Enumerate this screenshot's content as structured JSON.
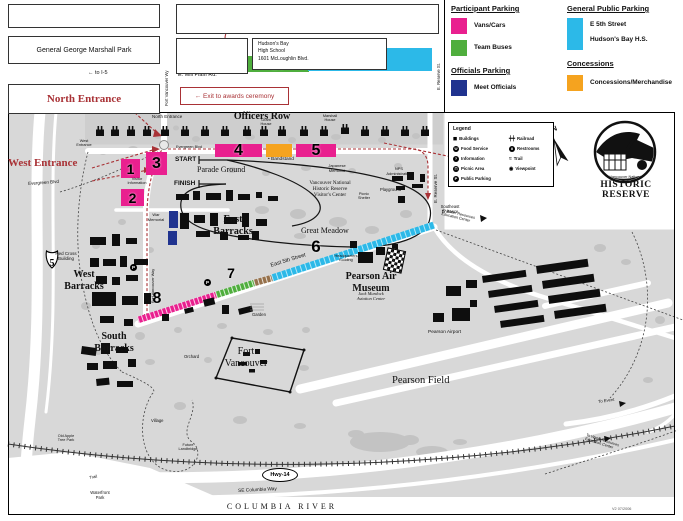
{
  "colors": {
    "pink": "#e9208f",
    "green": "#4fae3d",
    "cyan": "#2cb9e8",
    "navy": "#20338f",
    "orange": "#f5a31f",
    "red": "#a93236"
  },
  "top": {
    "marshall_park": "General George Marshall Park",
    "north_entrance": "North Entrance",
    "exit_note": "← Exit to awards ceremony",
    "school_lines": "Hudson's Bay\nHigh School\n1601 McLoughlin Blvd."
  },
  "legend": {
    "participant_title": "Participant Parking",
    "vans_cars": "Vans/Cars",
    "team_buses": "Team Buses",
    "officials_title": "Officials Parking",
    "meet_officials": "Meet Officials",
    "public_title": "General Public Parking",
    "public_line1": "E 5th Street",
    "public_line2": "Hudson's Bay H.S.",
    "concessions_title": "Concessions",
    "concessions_label": "Concessions/Merchandise"
  },
  "map_legend": {
    "title": "Legend",
    "col1": [
      {
        "g": "◼",
        "label": "Buildings",
        "plain": true
      },
      {
        "g": "Ψ",
        "label": "Food Service"
      },
      {
        "g": "?",
        "label": "Information"
      },
      {
        "g": "⊓",
        "label": "Picnic Area"
      },
      {
        "g": "P",
        "label": "Public Parking"
      }
    ],
    "col2": [
      {
        "g": "┿┿",
        "label": "Railroad",
        "plain": true
      },
      {
        "g": "ii",
        "label": "Restrooms"
      },
      {
        "g": "≈",
        "label": "Trail",
        "plain": true
      },
      {
        "g": "◉",
        "label": "Viewpoint",
        "plain": true
      }
    ]
  },
  "map": {
    "i5_label": "5",
    "labels": [
      {
        "id": "officers-row-label",
        "t": "Officers Row",
        "x": 262,
        "y": 111,
        "fs": 10,
        "serif": true,
        "b": true,
        "ctr": true
      },
      {
        "id": "north-entrance-map-label",
        "t": "North Entrance",
        "x": 152,
        "y": 114,
        "fs": 4.5
      },
      {
        "id": "grant-house-label",
        "t": "Grant\nHouse",
        "x": 266,
        "y": 118,
        "fs": 3.8,
        "ctr": true
      },
      {
        "id": "marshall-house-label",
        "t": "Marshall\nHouse",
        "x": 330,
        "y": 114,
        "fs": 3.8,
        "ctr": true
      },
      {
        "id": "evergreen-blvd-top-label",
        "t": "Evergreen Blvd",
        "x": 176,
        "y": 145,
        "fs": 3.8
      },
      {
        "id": "west-entrance-map-label",
        "t": "West\nEntrance",
        "x": 84,
        "y": 139,
        "fs": 3.8,
        "ctr": true
      },
      {
        "id": "west-entrance-label",
        "t": "West Entrance",
        "x": 8,
        "y": 157,
        "fs": 11,
        "serif": true,
        "b": true,
        "red": true
      },
      {
        "id": "evergreen-blvd-west-label",
        "t": "Evergreen Blvd",
        "x": 28,
        "y": 181,
        "fs": 4.5,
        "rot": -4
      },
      {
        "id": "start-label",
        "t": "START",
        "x": 175,
        "y": 156,
        "fs": 6.5,
        "b": true
      },
      {
        "id": "parade-ground-label",
        "t": "Parade Ground",
        "x": 197,
        "y": 165,
        "fs": 8,
        "serif": true
      },
      {
        "id": "finish-label",
        "t": "FINISH",
        "x": 174,
        "y": 180,
        "fs": 6.5,
        "b": true
      },
      {
        "id": "visitor-information-label",
        "t": "Visitor\nInformation",
        "x": 137,
        "y": 177,
        "fs": 3.8,
        "ctr": true
      },
      {
        "id": "bandstand-label",
        "t": "• Bandstand",
        "x": 268,
        "y": 157,
        "fs": 4.8
      },
      {
        "id": "japanese-memorial-label",
        "t": "Japanese\nMemorial",
        "x": 337,
        "y": 164,
        "fs": 4,
        "ctr": true
      },
      {
        "id": "visitor-center-label",
        "t": "Vancouver National\nHistoric Reserve\nVisitor's Center",
        "x": 330,
        "y": 181,
        "fs": 5.2,
        "serif": true,
        "ctr": true
      },
      {
        "id": "picnic-shelter-label",
        "t": "Picnic\nShelter",
        "x": 364,
        "y": 192,
        "fs": 3.8,
        "ctr": true
      },
      {
        "id": "nps-administration-label",
        "t": "NPS\nAdministration",
        "x": 399,
        "y": 167,
        "fs": 4,
        "ctr": true
      },
      {
        "id": "playground-label",
        "t": "Playground",
        "x": 380,
        "y": 188,
        "fs": 4.2
      },
      {
        "id": "war-memorial-label",
        "t": "War\nMemorial",
        "x": 156,
        "y": 213,
        "fs": 4,
        "ctr": true
      },
      {
        "id": "east-barracks-label",
        "t": "East\nBarracks",
        "x": 233,
        "y": 214,
        "fs": 10,
        "serif": true,
        "b": true,
        "ctr": true
      },
      {
        "id": "great-meadow-label",
        "t": "Great Meadow",
        "x": 301,
        "y": 226,
        "fs": 8,
        "serif": true
      },
      {
        "id": "red-cross-building-label",
        "t": "Red Cross\nBuilding",
        "x": 66,
        "y": 251,
        "fs": 4.5,
        "ctr": true
      },
      {
        "id": "west-barracks-label",
        "t": "West\nBarracks",
        "x": 84,
        "y": 269,
        "fs": 10,
        "serif": true,
        "b": true,
        "ctr": true
      },
      {
        "id": "south-barracks-label",
        "t": "South\nBarracks",
        "x": 114,
        "y": 331,
        "fs": 10,
        "serif": true,
        "b": true,
        "ctr": true
      },
      {
        "id": "east-5th-street-label",
        "t": "East 5th Street",
        "x": 270,
        "y": 263,
        "fs": 5.5,
        "rot": -17
      },
      {
        "id": "headquarters-building-label",
        "t": "Headquarters\nBuilding",
        "x": 346,
        "y": 254,
        "fs": 3.8,
        "ctr": true
      },
      {
        "id": "pearson-air-museum-label",
        "t": "Pearson Air\nMuseum",
        "x": 371,
        "y": 271,
        "fs": 10,
        "serif": true,
        "b": true,
        "ctr": true
      },
      {
        "id": "jack-murdock-label",
        "t": "Jack Murdock\nAviation Center",
        "x": 371,
        "y": 291,
        "fs": 4.5,
        "serif": true,
        "it": true,
        "ctr": true
      },
      {
        "id": "fort-vancouver-label",
        "t": "Fort\nVancouver",
        "x": 246,
        "y": 346,
        "fs": 10,
        "serif": true,
        "ctr": true
      },
      {
        "id": "garden-label",
        "t": "Garden",
        "x": 252,
        "y": 313,
        "fs": 4.2
      },
      {
        "id": "orchard-label",
        "t": "Orchard",
        "x": 184,
        "y": 355,
        "fs": 4.2
      },
      {
        "id": "village-label",
        "t": "Village",
        "x": 151,
        "y": 419,
        "fs": 4.2
      },
      {
        "id": "old-apple-tree-label",
        "t": "Old Apple\nTree Park",
        "x": 66,
        "y": 434,
        "fs": 3.8,
        "ctr": true
      },
      {
        "id": "future-landbridge-label",
        "t": "Future\nLandbridge",
        "x": 188,
        "y": 443,
        "fs": 3.8,
        "ctr": true
      },
      {
        "id": "trail-label",
        "t": "Trail",
        "x": 89,
        "y": 476,
        "fs": 4.2,
        "rot": -10
      },
      {
        "id": "waterfront-park-label",
        "t": "Waterfront\nPark",
        "x": 100,
        "y": 491,
        "fs": 4.2,
        "ctr": true
      },
      {
        "id": "pearson-airport-label",
        "t": "Pearson Airport",
        "x": 428,
        "y": 330,
        "fs": 4.8
      },
      {
        "id": "pearson-field-label",
        "t": "Pearson Field",
        "x": 392,
        "y": 375,
        "fs": 10.5,
        "serif": true
      },
      {
        "id": "columbia-river-label",
        "t": "COLUMBIA RIVER",
        "x": 282,
        "y": 502,
        "fs": 8,
        "serif": true,
        "ls": 3,
        "ctr": true
      },
      {
        "id": "se-columbia-way-label",
        "t": "SE Columbia Way",
        "x": 238,
        "y": 489,
        "fs": 4.8,
        "rot": -3
      },
      {
        "id": "e-reserve-st-map-label",
        "t": "E. Reserve St.",
        "x": 433,
        "y": 203,
        "fs": 4.5,
        "rot": -90
      },
      {
        "id": "southeast-entrance-label",
        "t": "Southeast\nEntrance",
        "x": 450,
        "y": 205,
        "fs": 4.2,
        "ctr": true
      },
      {
        "id": "east-entrance-label",
        "t": "East\nEntrance",
        "x": 482,
        "y": 147,
        "fs": 4.2,
        "ctr": true
      },
      {
        "id": "water-resources-1-label",
        "t": "to Water Resources\nEducation Center",
        "x": 443,
        "y": 208,
        "fs": 3.8,
        "rot": 14
      },
      {
        "id": "water-resources-2-label",
        "t": "To Water Resources\nEducation Center",
        "x": 587,
        "y": 433,
        "fs": 3.8,
        "rot": 18
      },
      {
        "id": "to-event-label",
        "t": "To Event",
        "x": 598,
        "y": 400,
        "fs": 4.2,
        "rot": -8
      },
      {
        "id": "map-code-label",
        "t": "V2 07/2006",
        "x": 612,
        "y": 507,
        "fs": 3.8,
        "c": "#555555"
      },
      {
        "id": "fort-vancouver-way-map-label",
        "t": "Fort Vancouver Way",
        "x": 151,
        "y": 303,
        "fs": 3.8,
        "rot": -90
      },
      {
        "id": "fort-vancouver-wy-top-label",
        "t": "Fort Vancouver Wy",
        "x": 165,
        "y": 106,
        "fs": 4.2,
        "rot": -90
      },
      {
        "id": "e-reserve-st-top-label",
        "t": "E. Reserve St.",
        "x": 437,
        "y": 90,
        "fs": 4.2,
        "rot": -90
      },
      {
        "id": "mclaughlin-blvd-label",
        "t": "McLaughlin Blvd.",
        "x": 231,
        "y": 26,
        "fs": 5.5
      },
      {
        "id": "to-i5-label",
        "t": "← to I-5",
        "x": 88,
        "y": 70,
        "fs": 5.5
      },
      {
        "id": "mill-plain-label",
        "t": "E. Mill Plain Rd.",
        "x": 178,
        "y": 72,
        "fs": 5.5
      },
      {
        "id": "compass-n-label",
        "t": "N",
        "x": 551,
        "y": 127,
        "fs": 7,
        "b": true,
        "rot": -20
      },
      {
        "id": "logo-line1-label",
        "t": "Vancouver National",
        "x": 626,
        "y": 175,
        "fs": 3.8,
        "ctr": true
      },
      {
        "id": "logo-line2-label",
        "t": "HISTORIC",
        "x": 626,
        "y": 180,
        "fs": 9.5,
        "serif": true,
        "b": true,
        "ctr": true,
        "ls": 0.5
      },
      {
        "id": "logo-line3-label",
        "t": "RESERVE",
        "x": 626,
        "y": 190,
        "fs": 9.5,
        "serif": true,
        "b": true,
        "ctr": true,
        "ls": 0.5
      }
    ],
    "markers": [
      {
        "id": "parking-area-1",
        "t": "1",
        "x": 121,
        "y": 159,
        "w": 19,
        "h": 19,
        "bg": "pink",
        "fs": 14
      },
      {
        "id": "parking-area-3",
        "t": "3",
        "x": 146,
        "y": 152,
        "w": 21,
        "h": 23,
        "bg": "pink",
        "fs": 16
      },
      {
        "id": "parking-area-2",
        "t": "2",
        "x": 121,
        "y": 189,
        "w": 23,
        "h": 17,
        "bg": "pink",
        "fs": 14
      },
      {
        "id": "parking-area-4",
        "t": "4",
        "x": 215,
        "y": 144,
        "w": 47,
        "h": 13,
        "bg": "pink",
        "fs": 16
      },
      {
        "id": "concessions-bar",
        "t": "",
        "x": 266,
        "y": 144,
        "w": 26,
        "h": 13,
        "bg": "orange"
      },
      {
        "id": "parking-area-5",
        "t": "5",
        "x": 296,
        "y": 144,
        "w": 40,
        "h": 13,
        "bg": "pink",
        "fs": 16
      },
      {
        "id": "route-number-6",
        "t": "6",
        "x": 306,
        "y": 237,
        "w": 20,
        "h": 20,
        "fs": 17
      },
      {
        "id": "route-number-7",
        "t": "7",
        "x": 223,
        "y": 265,
        "w": 16,
        "h": 16,
        "fs": 14
      },
      {
        "id": "route-number-8",
        "t": "8",
        "x": 148,
        "y": 290,
        "w": 18,
        "h": 18,
        "fs": 16
      },
      {
        "id": "parking-area-10",
        "t": "10",
        "x": 247,
        "y": 56,
        "w": 62,
        "h": 16,
        "bg": "green",
        "fs": 13
      },
      {
        "id": "hudsons-bay-hs-lot",
        "t": "",
        "x": 308,
        "y": 48,
        "w": 124,
        "h": 23,
        "bg": "cyan"
      },
      {
        "id": "officials-parking-bar-1",
        "t": "",
        "x": 169,
        "y": 211,
        "w": 9,
        "h": 17,
        "bg": "navy"
      },
      {
        "id": "officials-parking-bar-2",
        "t": "",
        "x": 168,
        "y": 231,
        "w": 9,
        "h": 14,
        "bg": "navy"
      },
      {
        "id": "hwy-14-badge",
        "t": "Hwy-14",
        "x": 262,
        "y": 468,
        "w": 34,
        "h": 12,
        "cls": "oval",
        "fs": 5.5
      },
      {
        "id": "finish-flag",
        "t": "",
        "x": 385,
        "y": 249,
        "w": 17,
        "h": 21,
        "cls": "checker",
        "rot": 12
      },
      {
        "id": "parking-icon-1",
        "t": "P",
        "x": 204,
        "y": 279,
        "w": 7,
        "h": 7,
        "cls": "bcircle",
        "fs": 4.5
      },
      {
        "id": "parking-icon-2",
        "t": "P",
        "x": 130,
        "y": 264,
        "w": 7,
        "h": 7,
        "cls": "bcircle",
        "fs": 4.5
      }
    ]
  }
}
